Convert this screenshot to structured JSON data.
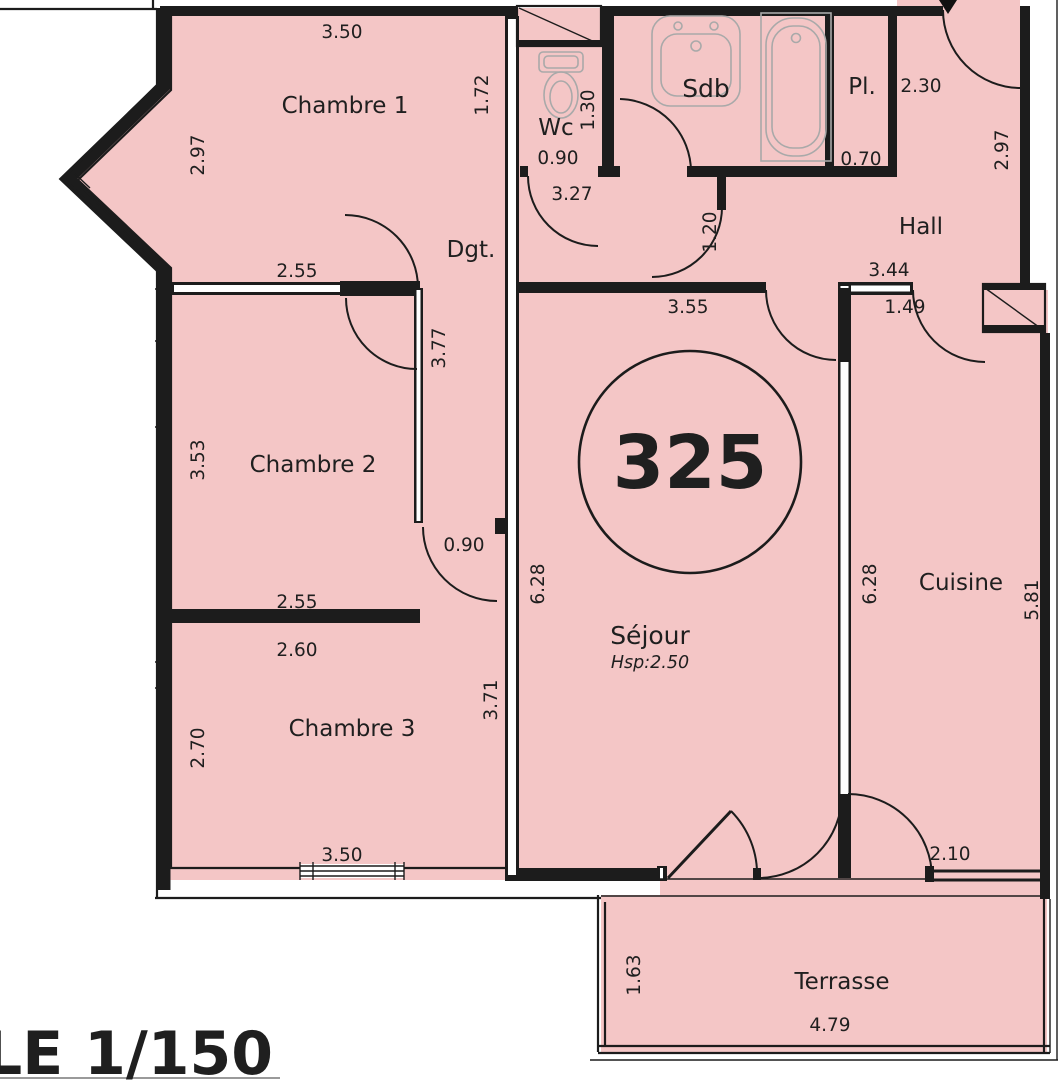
{
  "plan": {
    "unit_number": "325",
    "scale_label": "LE 1/150",
    "labels": {
      "chambre1": "Chambre 1",
      "chambre2": "Chambre 2",
      "chambre3": "Chambre 3",
      "wc": "Wc",
      "sdb": "Sdb",
      "pl": "Pl.",
      "hall": "Hall",
      "dgt": "Dgt.",
      "sejour": "Séjour",
      "sejour_ceiling": "Hsp:2.50",
      "cuisine": "Cuisine",
      "terrasse": "Terrasse"
    },
    "dims": {
      "ch1_width": "3.50",
      "ch1_left": "2.97",
      "ch1_right": "1.72",
      "wc_depth": "1.30",
      "wc_width": "0.90",
      "corridor_len": "3.27",
      "entry_width": "2.30",
      "pl_width": "0.70",
      "hall_right": "2.97",
      "ch2_top": "2.55",
      "dgt_len": "3.77",
      "hall_width": "3.44",
      "kitchen_door": "1.49",
      "sejour_width": "3.55",
      "passage": "1.20",
      "ch2_left": "3.53",
      "ch2_door": "0.90",
      "sejour_height": "6.28",
      "cuisine_left": "6.28",
      "cuisine_right": "5.81",
      "ch2_bottom": "2.55",
      "ch3_top": "2.60",
      "ch3_left": "2.70",
      "ch3_right": "3.71",
      "ch3_width": "3.50",
      "terrace_doors": "2.10",
      "terrace_depth": "1.63",
      "terrace_width": "4.79"
    },
    "colors": {
      "floor": "#f4c6c6",
      "wall": "#1c1c1c",
      "fixture": "#a9a9a9",
      "text": "#1f1f1f"
    }
  }
}
